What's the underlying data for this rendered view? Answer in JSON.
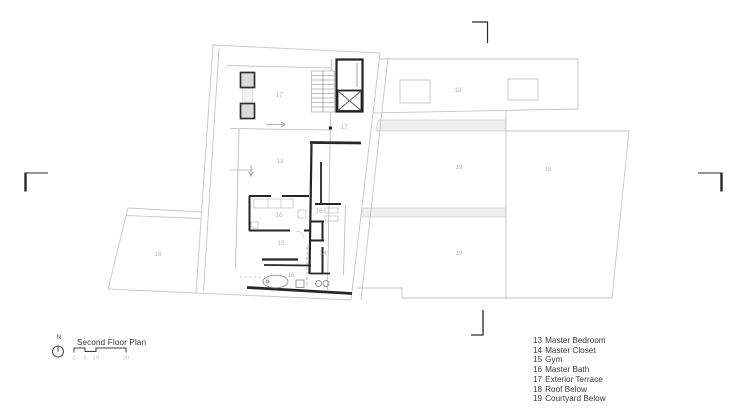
{
  "drawing": {
    "title": "Second Floor Plan",
    "north_label": "N",
    "scale_ticks": [
      "0",
      "5",
      "10",
      "20"
    ]
  },
  "legend": {
    "items": [
      {
        "number": "13",
        "name": "Master Bedroom"
      },
      {
        "number": "14",
        "name": "Master Closet"
      },
      {
        "number": "15",
        "name": "Gym"
      },
      {
        "number": "16",
        "name": "Master Bath"
      },
      {
        "number": "17",
        "name": "Exterior Terrace"
      },
      {
        "number": "18",
        "name": "Roof Below"
      },
      {
        "number": "19",
        "name": "Courtyard Below"
      }
    ]
  },
  "plan": {
    "room_labels": [
      {
        "room": "exterior-terrace-west",
        "text": "17"
      },
      {
        "room": "exterior-terrace-east",
        "text": "17"
      },
      {
        "room": "master-bedroom",
        "text": "13"
      },
      {
        "room": "master-bath-west",
        "text": "16"
      },
      {
        "room": "master-bath-east",
        "text": "16"
      },
      {
        "room": "gym",
        "text": "15"
      },
      {
        "room": "master-closet",
        "text": "14"
      },
      {
        "room": "master-bath-south",
        "text": "16"
      },
      {
        "room": "roof-below-west",
        "text": "18"
      },
      {
        "room": "roof-below-north",
        "text": "18"
      },
      {
        "room": "courtyard-below-upper",
        "text": "19"
      },
      {
        "room": "roof-below-east",
        "text": "18"
      },
      {
        "room": "courtyard-below-lower",
        "text": "19"
      }
    ]
  },
  "colors": {
    "site_outline": "#c6c6c6",
    "wall_dark": "#262626",
    "wall_medium": "#9c9c9c",
    "room_label": "#b6b6b6",
    "band_fill": "#ededed"
  }
}
